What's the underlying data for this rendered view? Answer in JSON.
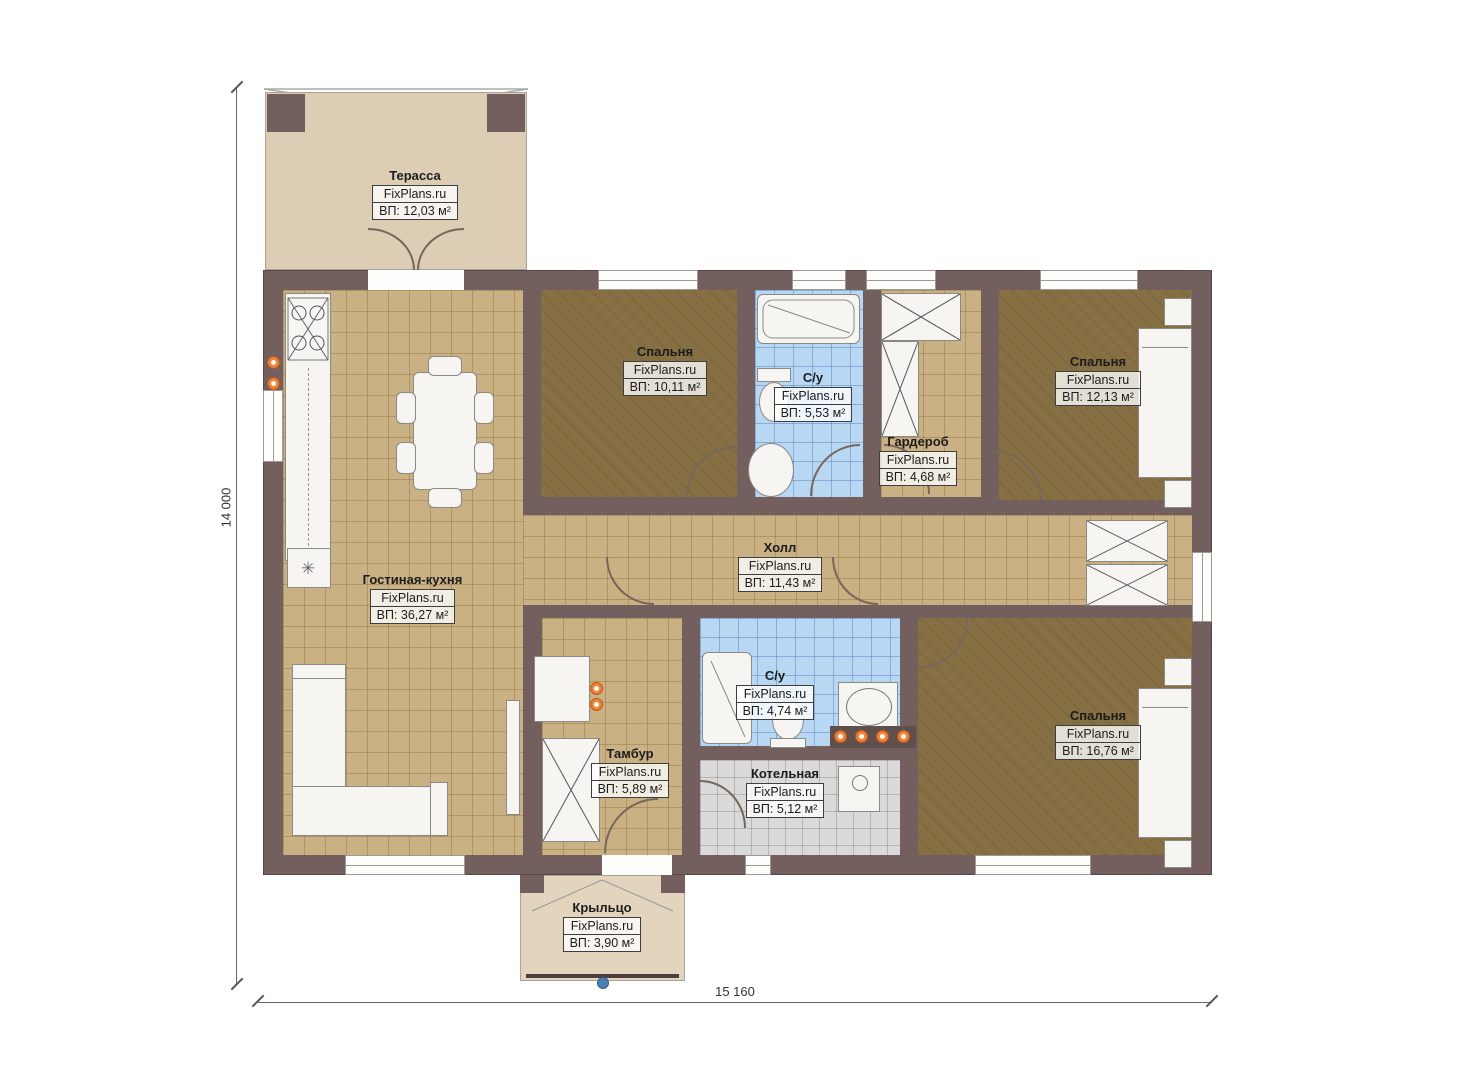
{
  "plan": {
    "watermark": "FixPlans.ru",
    "dimensions": {
      "height_label": "14 000",
      "width_label": "15 160"
    },
    "rooms": [
      {
        "id": "terrace",
        "name": "Терасса",
        "area": "ВП: 12,03 м²"
      },
      {
        "id": "bedroom-top-left",
        "name": "Спальня",
        "area": "ВП: 10,11 м²"
      },
      {
        "id": "bathroom-top",
        "name": "С/у",
        "area": "ВП: 5,53 м²"
      },
      {
        "id": "wardrobe-room",
        "name": "Гардероб",
        "area": "ВП: 4,68 м²"
      },
      {
        "id": "bedroom-top-right",
        "name": "Спальня",
        "area": "ВП: 12,13 м²"
      },
      {
        "id": "hall",
        "name": "Холл",
        "area": "ВП: 11,43 м²"
      },
      {
        "id": "living-kitchen",
        "name": "Гостиная-кухня",
        "area": "ВП: 36,27 м²"
      },
      {
        "id": "bathroom-bottom",
        "name": "С/у",
        "area": "ВП: 4,74 м²"
      },
      {
        "id": "vestibule",
        "name": "Тамбур",
        "area": "ВП: 5,89 м²"
      },
      {
        "id": "boiler-room",
        "name": "Котельная",
        "area": "ВП: 5,12 м²"
      },
      {
        "id": "bedroom-bottom-right",
        "name": "Спальня",
        "area": "ВП: 16,76 м²"
      },
      {
        "id": "porch",
        "name": "Крыльцо",
        "area": "ВП: 3,90 м²"
      }
    ],
    "colors": {
      "wall": "#73605e",
      "floor_tile_tan": "#c9b183",
      "floor_bedroom": "#867043",
      "floor_bath_blue": "#b7d7f2",
      "floor_boiler_gray": "#dadada",
      "floor_terrace": "#dccdb4",
      "accent_orange": "#f08033",
      "node_blue": "#4a7fb5"
    }
  }
}
